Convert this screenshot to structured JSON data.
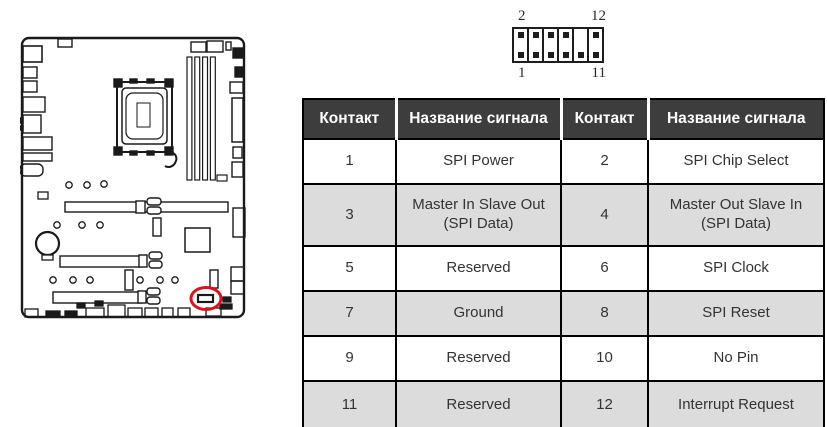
{
  "diagram": {
    "description": "motherboard-outline-with-highlighted-tpm-connector",
    "line_color": "#1a1a1a",
    "highlight_color": "#e0101f"
  },
  "pin_header": {
    "columns": 6,
    "rows": 2,
    "labels": {
      "top_left": "2",
      "top_right": "12",
      "bottom_left": "1",
      "bottom_right": "11"
    },
    "missing_pin": "10",
    "missing_pin_position": "top row, column 5"
  },
  "table": {
    "header_bg": "#3d3d3d",
    "alt_row_bg": "#dcdcdc",
    "headers": [
      "Контакт",
      "Название сигнала",
      "Контакт",
      "Название сигнала"
    ],
    "rows": [
      [
        "1",
        "SPI Power",
        "2",
        "SPI Chip Select"
      ],
      [
        "3",
        "Master In Slave Out\n(SPI Data)",
        "4",
        "Master Out Slave In\n(SPI Data)"
      ],
      [
        "5",
        "Reserved",
        "6",
        "SPI Clock"
      ],
      [
        "7",
        "Ground",
        "8",
        "SPI Reset"
      ],
      [
        "9",
        "Reserved",
        "10",
        "No Pin"
      ],
      [
        "11",
        "Reserved",
        "12",
        "Interrupt Request"
      ]
    ]
  }
}
